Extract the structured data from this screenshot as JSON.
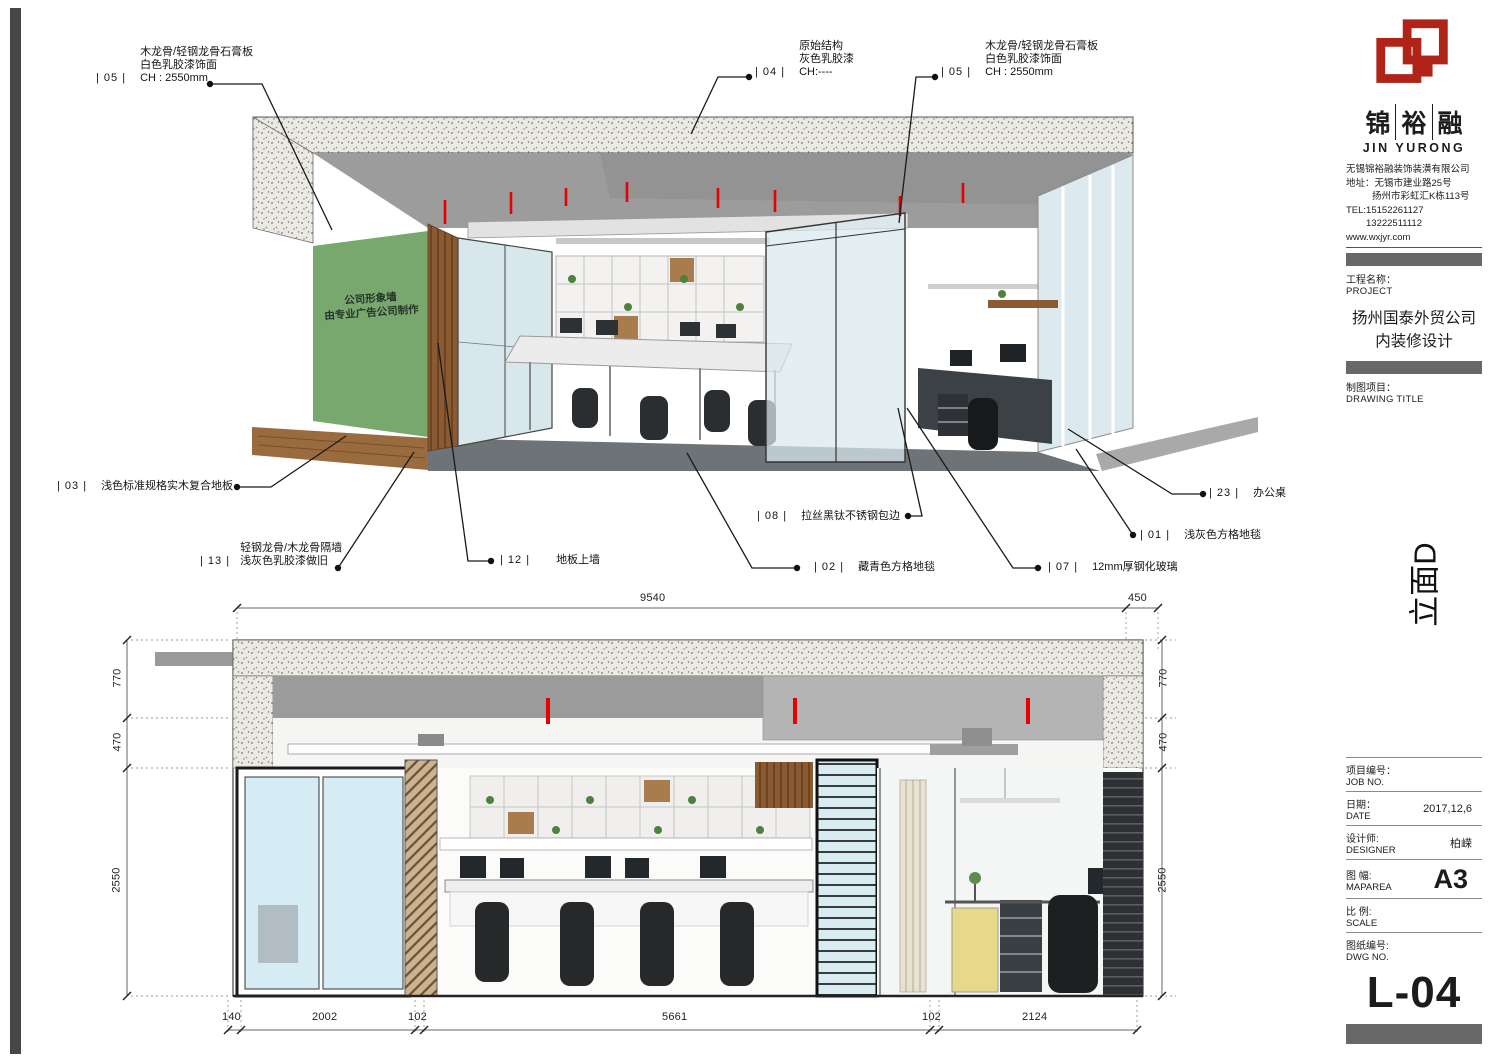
{
  "titleblock": {
    "brand": {
      "c1": "锦",
      "c2": "裕",
      "c3": "融",
      "en": "JIN YURONG",
      "logo_color": "#b02318"
    },
    "company": {
      "name": "无锡锦裕融装饰装潢有限公司",
      "addr1": "地址：无锡市建业路25号",
      "addr2": "扬州市彩虹汇K栋113号",
      "tel1": "TEL:15152261127",
      "tel2": "13222511112",
      "web": "www.wxjyr.com"
    },
    "project": {
      "label_cn": "工程名称：",
      "label_en": "PROJECT",
      "name1": "扬州国泰外贸公司",
      "name2": "内装修设计"
    },
    "drawing_title": {
      "label_cn": "制图项目：",
      "label_en": "DRAWING TITLE"
    },
    "view_label": "立面D",
    "fields": {
      "job": {
        "cn": "项目编号：",
        "en": "JOB NO.",
        "value": ""
      },
      "date": {
        "cn": "日期：",
        "en": "DATE",
        "value": "2017,12,6"
      },
      "designer": {
        "cn": "设计师:",
        "en": "DESIGNER",
        "value": "柏嵘"
      },
      "maparea": {
        "cn": "图 幅:",
        "en": "MAPAREA",
        "value": "A3"
      },
      "scale": {
        "cn": "比 例:",
        "en": "SCALE",
        "value": ""
      },
      "dwg": {
        "cn": "图纸编号:",
        "en": "DWG NO.",
        "value": "L-04"
      }
    }
  },
  "perspective": {
    "green_wall": {
      "line1": "公司形象墙",
      "line2": "由专业广告公司制作",
      "color": "#79a86e"
    },
    "callouts": {
      "c05l": {
        "tag": "| 05 |",
        "l1": "木龙骨/轻钢龙骨石膏板",
        "l2": "白色乳胶漆饰面",
        "l3": "CH : 2550mm"
      },
      "c04": {
        "tag": "| 04 |",
        "l1": "原始结构",
        "l2": "灰色乳胶漆",
        "l3": "CH:----"
      },
      "c05r": {
        "tag": "| 05 |",
        "l1": "木龙骨/轻钢龙骨石膏板",
        "l2": "白色乳胶漆饰面",
        "l3": "CH : 2550mm"
      },
      "c03": {
        "tag": "| 03 |",
        "l1": "浅色标准规格实木复合地板"
      },
      "c13": {
        "tag": "| 13 |",
        "l1": "轻钢龙骨/木龙骨隔墙",
        "l2": "浅灰色乳胶漆做旧"
      },
      "c12": {
        "tag": "| 12 |",
        "l1": "地板上墙"
      },
      "c08": {
        "tag": "| 08 |",
        "l1": "拉丝黑钛不锈钢包边"
      },
      "c02": {
        "tag": "| 02 |",
        "l1": "藏青色方格地毯"
      },
      "c07": {
        "tag": "| 07 |",
        "l1": "12mm厚钢化玻璃"
      },
      "c01": {
        "tag": "| 01 |",
        "l1": "浅灰色方格地毯"
      },
      "c23": {
        "tag": "| 23 |",
        "l1": "办公桌"
      }
    }
  },
  "elevation": {
    "dims_top": {
      "d1": "9540",
      "d2": "450"
    },
    "dims_left": {
      "d1": "770",
      "d2": "470",
      "d3": "2550"
    },
    "dims_right": {
      "d1": "770",
      "d2": "470",
      "d3": "2550"
    },
    "dims_bottom": {
      "d1": "140",
      "d2": "2002",
      "d3": "102",
      "d4": "5661",
      "d5": "102",
      "d6": "2124"
    }
  }
}
